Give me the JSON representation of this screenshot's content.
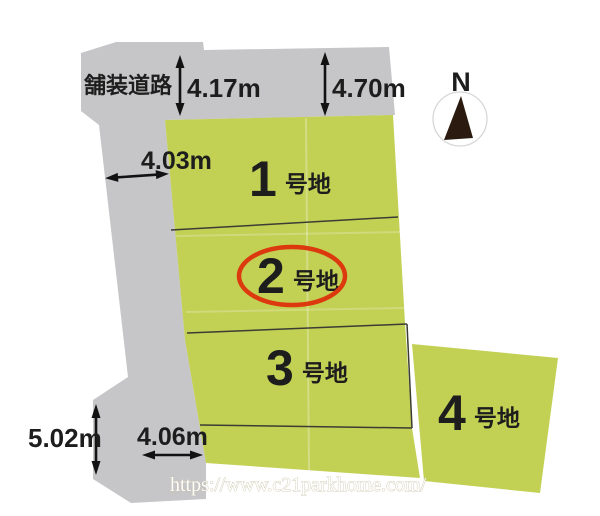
{
  "road": {
    "label": "舗装道路"
  },
  "plots": [
    {
      "number": "1",
      "suffix": "号地",
      "highlighted": false
    },
    {
      "number": "2",
      "suffix": "号地",
      "highlighted": true
    },
    {
      "number": "3",
      "suffix": "号地",
      "highlighted": false
    },
    {
      "number": "4",
      "suffix": "号地",
      "highlighted": false
    }
  ],
  "dimensions": {
    "top_left": "4.17m",
    "top_right": "4.70m",
    "upper_left": "4.03m",
    "lower_left": "5.02m",
    "bottom": "4.06m"
  },
  "compass": {
    "label": "N"
  },
  "watermark": {
    "text": "https://www.c21parkhome.com/"
  },
  "colors": {
    "land": "#c2d054",
    "road": "#c6c5c7",
    "boundary": "#3c3c34",
    "highlight": "#dc3a0e",
    "text": "#1d1d1d"
  }
}
